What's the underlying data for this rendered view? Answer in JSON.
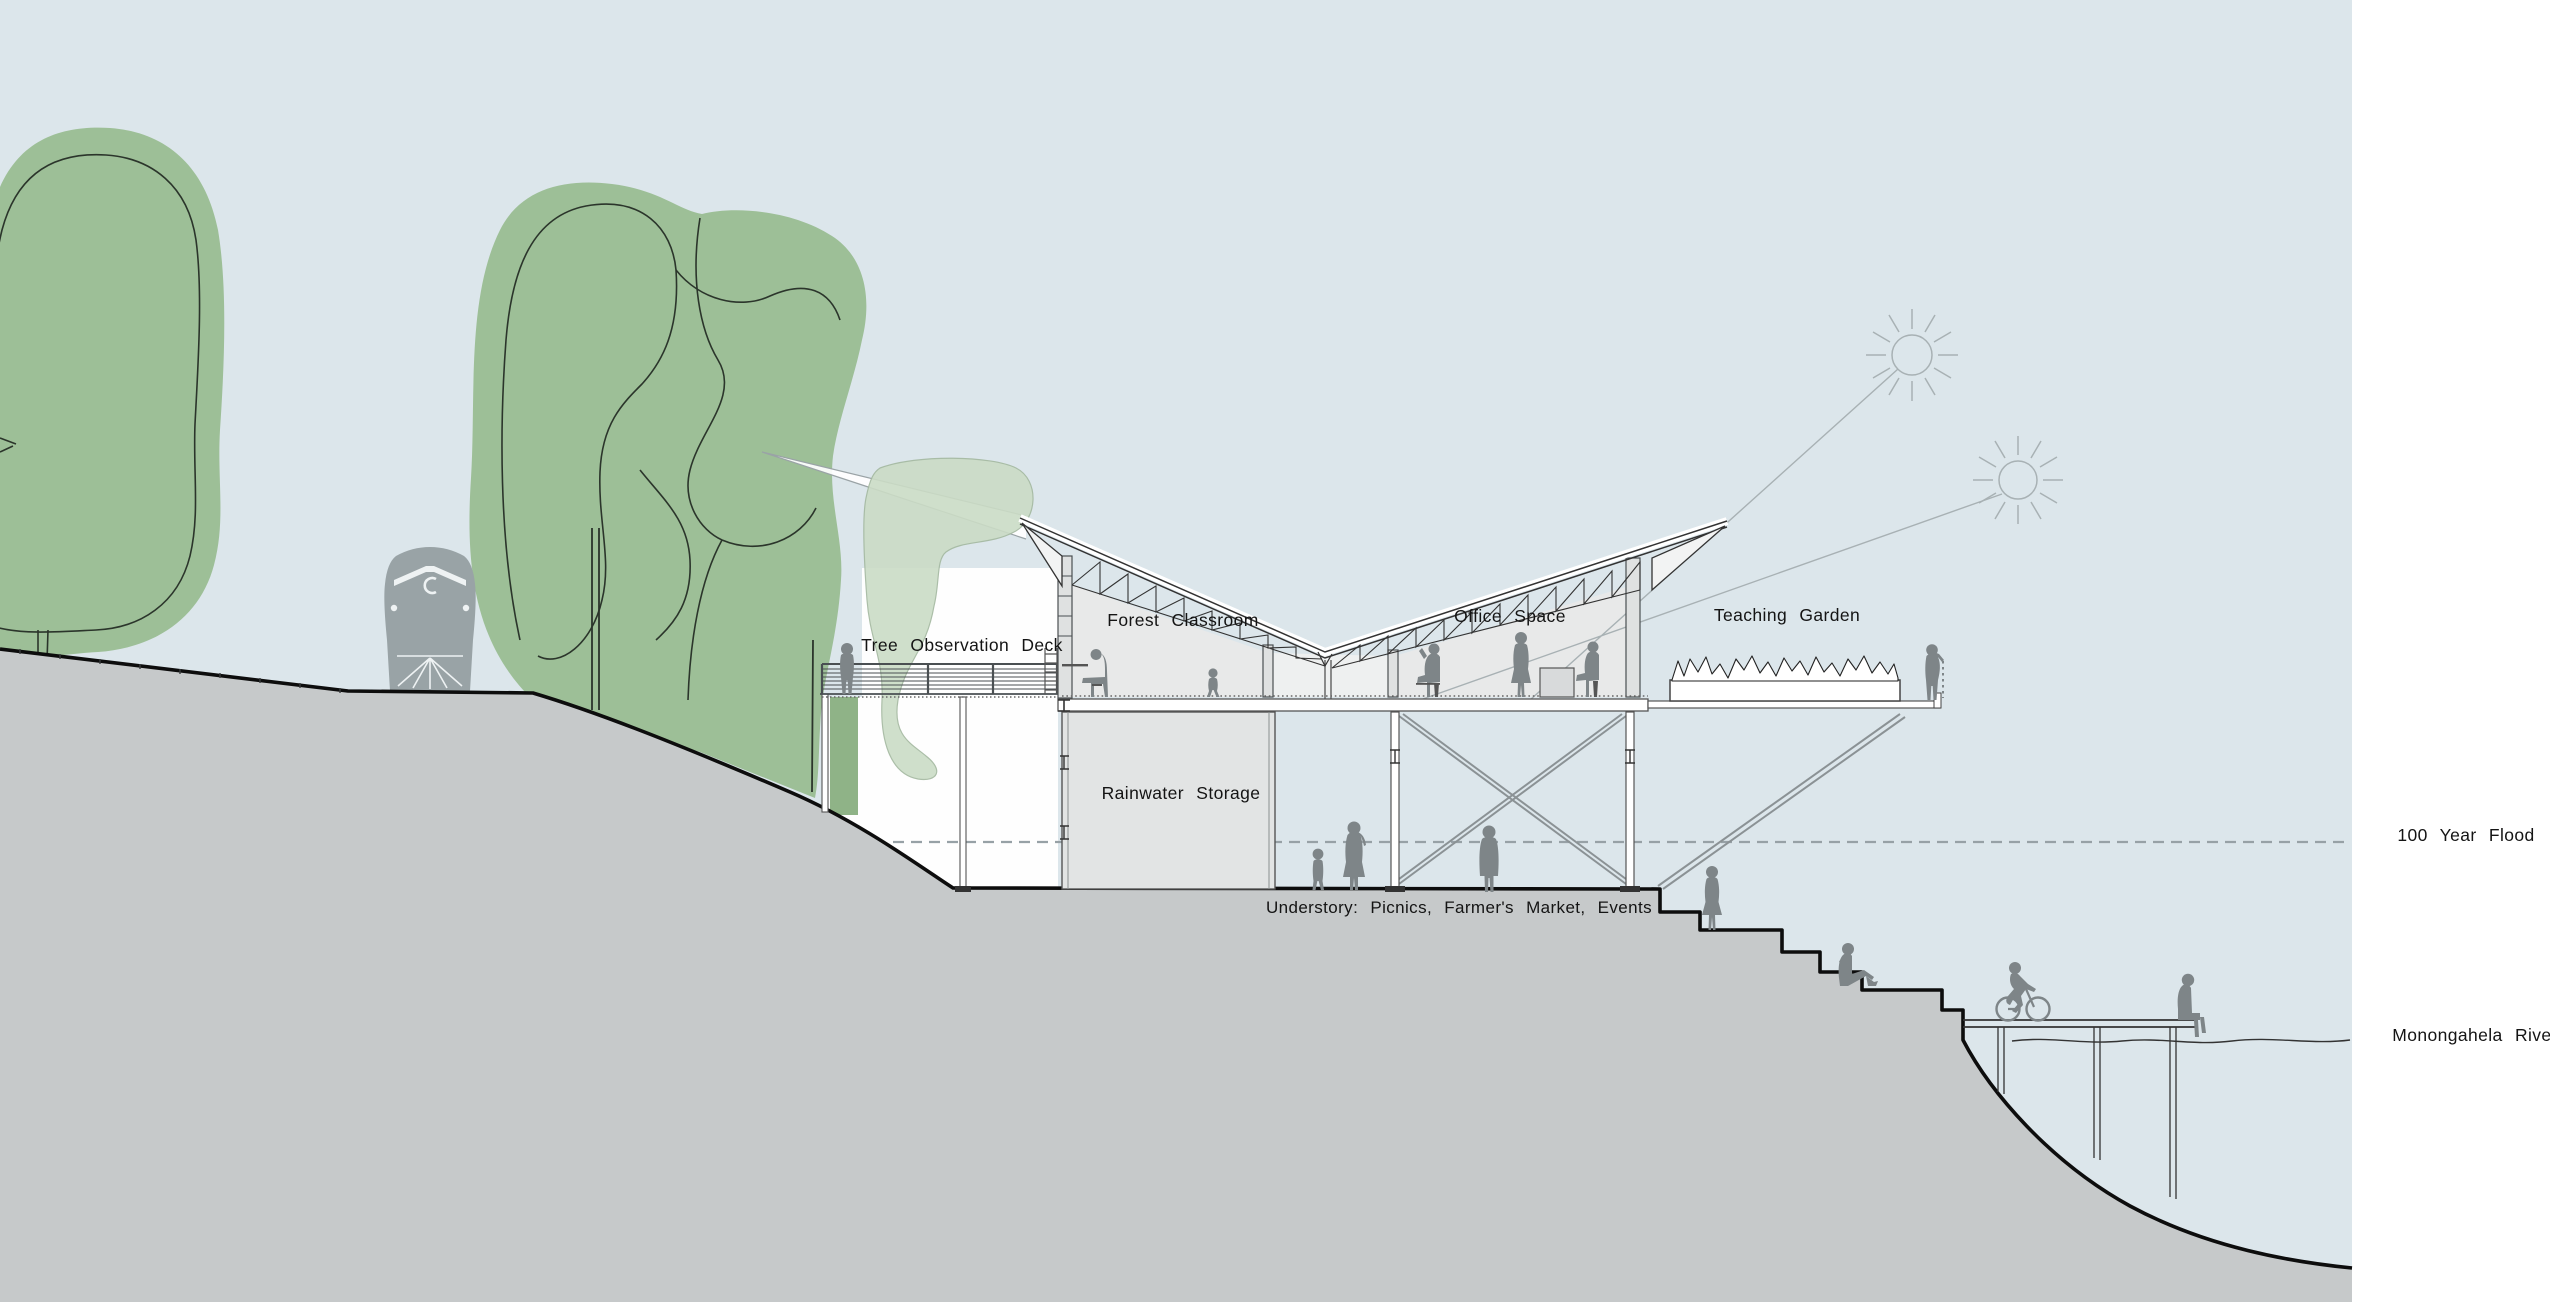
{
  "title": "Riverfront pavilion section drawing",
  "labels": {
    "tree_observation_deck": "Tree Observation Deck",
    "forest_classroom": "Forest Classroom",
    "office_space": "Office Space",
    "teaching_garden": "Teaching Garden",
    "rainwater_storage": "Rainwater Storage",
    "understory": "Understory: Picnics, Farmer's Market, Events",
    "flood": "100 Year Flood",
    "river": "Monongahela River"
  },
  "colors": {
    "sky": "#dce6eb",
    "paper": "#ffffff",
    "tree": "#9dbf97",
    "treeline": "#2b352b",
    "pale": "#cbdcc6",
    "strip": "#8fb387",
    "hill": "#c6c9ca",
    "edge": "#0d0d0d",
    "figure": "#7e8588",
    "train": "#99a3a6",
    "struct": "#4b5154",
    "lightline": "#8b9295",
    "sun": "#a8b1b4",
    "flood": "#97a1a6",
    "room": "#e8e9e9",
    "gap": "#eef0f0",
    "box": "#e2e4e4",
    "ink": "#141414"
  }
}
